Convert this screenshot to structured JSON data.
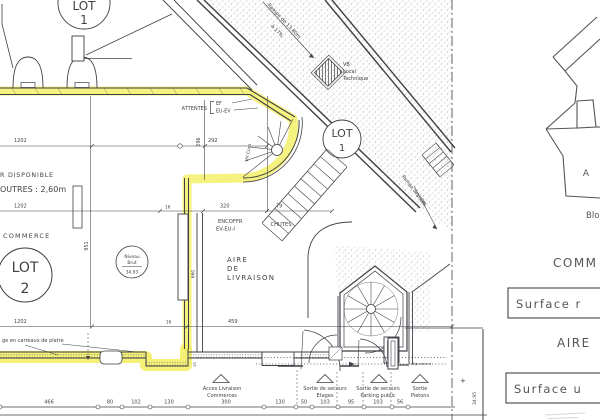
{
  "colors": {
    "highlight": "#f3ef5f",
    "ink": "#3f3f46",
    "panel_ink": "#55555b",
    "paper": "#ffffff"
  },
  "plan": {
    "lot1_top": {
      "l1": "LOT",
      "l2": "1"
    },
    "lot1": {
      "l1": "LOT",
      "l2": "1"
    },
    "lot2": {
      "l1": "LOT",
      "l2": "2"
    },
    "niveau": {
      "l1": "Niveau",
      "l2": "Brut",
      "l3": "34.93"
    },
    "notes": {
      "hauteur_l1": "R DISPONIBLE",
      "hauteur_l2": "OUTRES : 2,60m",
      "commerce": "COMMERCE",
      "aire_l1": "AIRE",
      "aire_l2": "DE",
      "aire_l3": "LIVRAISON",
      "attentes": "ATTENTES",
      "ef": "EF",
      "eu_ev": "EU-EV",
      "encoffr_l1": "ENCOFFR",
      "encoffr_l2": "EV-EU-I",
      "chutes": "CHUTES",
      "vh_com": "VH Com",
      "vb_l1": "VB",
      "vb_l2": "Local",
      "vb_l3": "Technique",
      "rampe1_l1": "Rampe de 13.80m",
      "rampe1_l2": "à 17%",
      "rampe2_l1": "Rampe de 3.3m",
      "rampe2_l2": "à 33%",
      "doublage": "ge en carreaux de platre",
      "alignement": "alignement",
      "level_mark": "+",
      "level_value": "34.95"
    },
    "dims": {
      "w1202_top": "1202",
      "w292": "292",
      "h296": "296",
      "h951": "951",
      "w1202_mid": "1202",
      "t16_mid": "16",
      "w320": "320",
      "w79": "79",
      "h660": "660",
      "w1202_bot": "1202",
      "t16_bot": "16",
      "w459": "459",
      "t15": "15"
    },
    "chain": [
      "466",
      "80",
      "102",
      "130",
      "300",
      "130",
      "50",
      "103",
      "95",
      "103",
      "56"
    ],
    "exits": [
      {
        "l1": "Acces Livraison",
        "l2": "Commerces"
      },
      {
        "l1": "Sortie de secours",
        "l2": "Etages"
      },
      {
        "l1": "Sortie de secours",
        "l2": "Parking public"
      },
      {
        "l1": "Sortie",
        "l2": "Pietons"
      }
    ]
  },
  "panel": {
    "bloc": "Blo",
    "letter": "A",
    "heading_commerce": "COMM",
    "surface_box1": "Surface r",
    "heading_aire": "AIRE",
    "surface_box2": "Surface u"
  }
}
